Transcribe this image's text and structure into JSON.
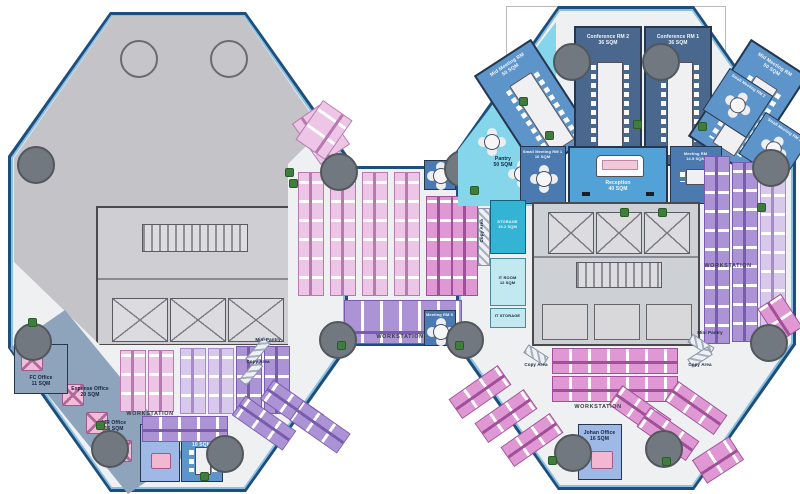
{
  "rooms": {
    "fc_office": {
      "name": "FC Office",
      "area": "11 SQM"
    },
    "expense_office": {
      "name": "Expense Office",
      "area": "20 SQM"
    },
    "mr_office": {
      "name": "MR Office",
      "area": "16 SQM"
    },
    "gm_office": {
      "name": "GM Office",
      "area": "23.5 SQM"
    },
    "media_meeting_rm": {
      "name": "Media Meeting RM",
      "area": "10 SQM"
    },
    "johan_office": {
      "name": "Johan Office",
      "area": "16 SQM"
    },
    "pantry": {
      "name": "Pantry",
      "area": "50 SQM"
    },
    "mid_meeting_rm_left": {
      "name": "Mid Meeting RM",
      "area": "50 SQM"
    },
    "conference_rm_2": {
      "name": "Conference RM 2",
      "area": "36 SQM"
    },
    "conference_rm_1": {
      "name": "Conference RM 1",
      "area": "36 SQM"
    },
    "mid_meeting_rm_right": {
      "name": "Mid Meeting RM",
      "area": "50 SQM"
    },
    "small_meeting_rm_2": {
      "name": "Small Meeting RM 2",
      "area": "10 SQM"
    },
    "small_meeting_rm_3": {
      "name": "Small Meeting RM 3",
      "area": "10 SQM"
    },
    "small_meeting_rm_1": {
      "name": "Small Meeting RM 1",
      "area": "10 SQM"
    },
    "reception": {
      "name": "Reception",
      "area": "40 SQM"
    },
    "meeting_rm": {
      "name": "Meeting RM",
      "area": "14.5 SQM"
    },
    "meeting_rm_4": {
      "name": "Meeting RM",
      "area": ""
    },
    "meeting_rm_5": {
      "name": "Meeting RM 5",
      "area": "9 SQM"
    },
    "storage": {
      "name": "STORAGE",
      "area": "19.2 SQM"
    },
    "it_room": {
      "name": "IT ROOM",
      "area": "12 SQM"
    },
    "it_storage": {
      "name": "IT STORAGE",
      "area": "8 SQM"
    }
  },
  "labels": {
    "workstation": "WORKSTATION",
    "mini_pantry": "Mini Pantry",
    "copy_area": "Copy Area"
  },
  "colors": {
    "outline_blue": "#1c4f7e",
    "window_blue": "#8cc0e0",
    "floor": "#eef0f2",
    "shell_gray": "#c4c4c8",
    "conference_blue": "#4a688e",
    "meeting_blue": "#5d95cb",
    "small_meeting_blue": "#4a7ab0",
    "reception_blue": "#52a2d8",
    "pantry_cyan": "#85d6ea",
    "storage_teal": "#34b4d4",
    "it_cyan": "#c2e8f0",
    "office_blue": "#9fb9e6",
    "office_slate": "#8ea4bc",
    "ws_pink": "#edc6e7",
    "ws_magenta": "#e098d4",
    "ws_purple": "#ab93d6",
    "plant_green": "#3e7d3c"
  }
}
